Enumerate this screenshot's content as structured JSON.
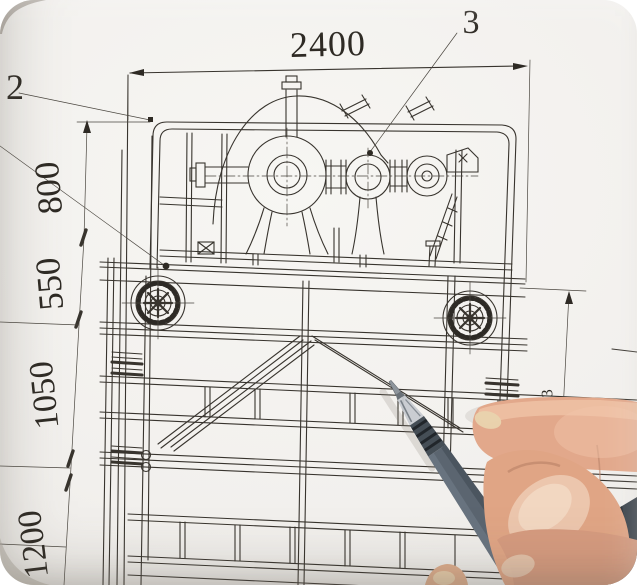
{
  "scene": {
    "description": "Photo of a mechanical engineering assembly drawing (gear reducer on a welded truss frame) with a hand holding a pen pointing at a diagonal brace",
    "paper_color": "#f2f0ed",
    "line_color": "#38342e"
  },
  "drawing": {
    "balloons": {
      "two": "2",
      "three": "3"
    },
    "dimensions": {
      "top_width": "2400",
      "left_chain": [
        "800",
        "550",
        "1050",
        "1200"
      ],
      "right_height": "1403"
    }
  },
  "photo": {
    "pen_color": "#5b6570",
    "skin_color": "#dfa689"
  }
}
